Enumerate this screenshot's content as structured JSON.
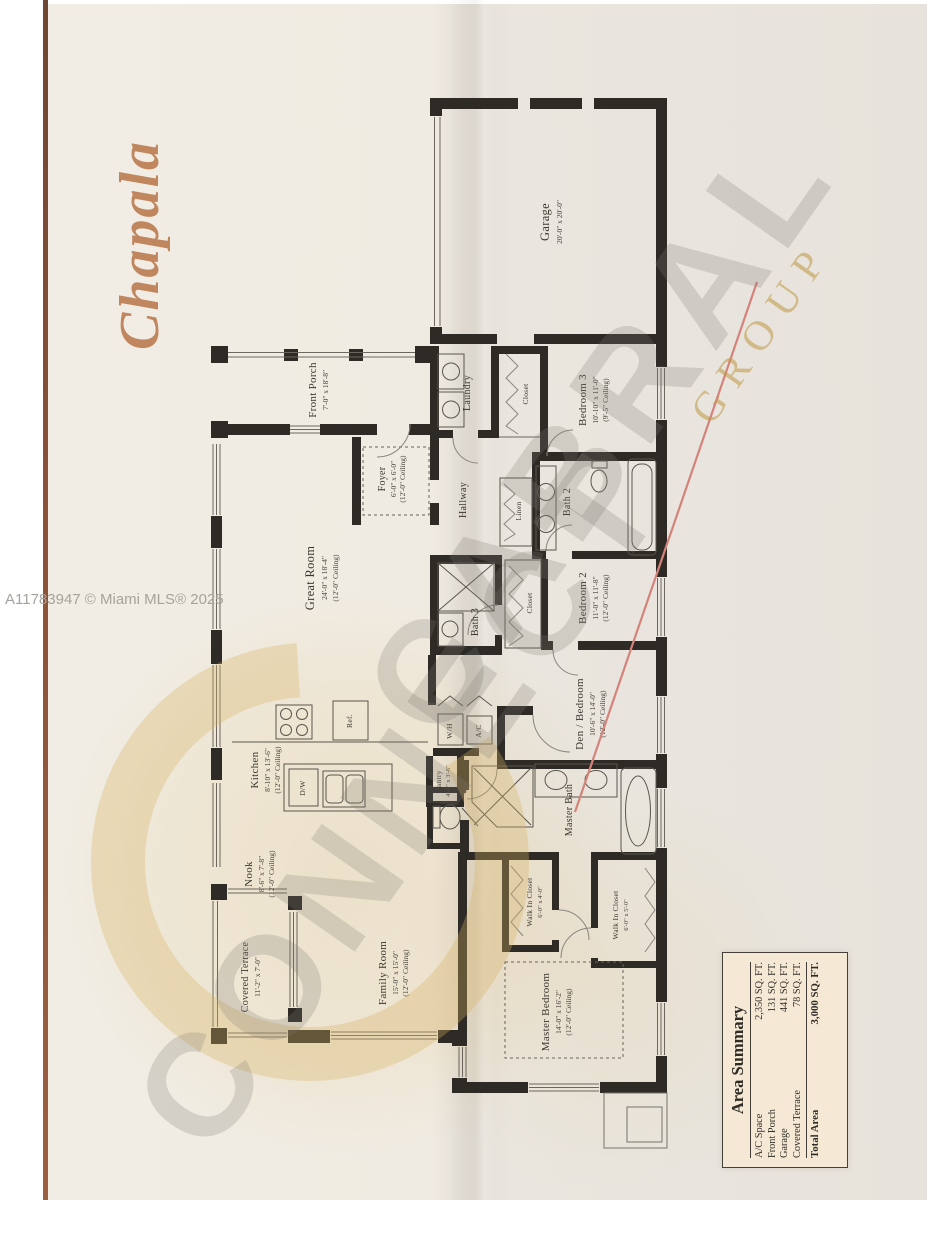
{
  "plan": {
    "model_name": "Chapala"
  },
  "credit": {
    "text": "A11783947 © Miami MLS® 2025"
  },
  "watermark": {
    "word1": "CONNECT",
    "word2": "CABRAL",
    "word3": "GROUP",
    "logo_letter": "C"
  },
  "colors": {
    "accent_copper": "#c0875f",
    "wall": "#2e2b27",
    "watermark_gold": "#d8b260",
    "watermark_gray": "#7d7972",
    "red_line": "#d4837b",
    "summary_bg": "#f5e9d5"
  },
  "rooms": [
    {
      "name": "Garage",
      "dims": "20'-0\" x 20'-0\"",
      "ceiling": ""
    },
    {
      "name": "Front Porch",
      "dims": "7'-0\" x 18'-8\"",
      "ceiling": ""
    },
    {
      "name": "Laundry",
      "dims": "",
      "ceiling": ""
    },
    {
      "name": "Closet",
      "dims": "",
      "ceiling": ""
    },
    {
      "name": "Bedroom 3",
      "dims": "10'-10\" x 11'-0\"",
      "ceiling": "(9'-5\" Ceiling)"
    },
    {
      "name": "Foyer",
      "dims": "6'-0\" x 6'-0\"",
      "ceiling": "(12'-0\" Ceiling)"
    },
    {
      "name": "Hallway",
      "dims": "",
      "ceiling": ""
    },
    {
      "name": "Linen",
      "dims": "",
      "ceiling": ""
    },
    {
      "name": "Bath 2",
      "dims": "",
      "ceiling": ""
    },
    {
      "name": "Great Room",
      "dims": "24'-0\" x 18'-4\"",
      "ceiling": "(12'-0\" Ceiling)"
    },
    {
      "name": "Bath 3",
      "dims": "",
      "ceiling": ""
    },
    {
      "name": "Closet",
      "dims": "",
      "ceiling": ""
    },
    {
      "name": "Bedroom 2",
      "dims": "11'-0\" x 11'-8\"",
      "ceiling": "(12'-0\" Ceiling)"
    },
    {
      "name": "Den / Bedroom",
      "dims": "10'-6\" x 14'-0\"",
      "ceiling": "(12'-0\" Ceiling)"
    },
    {
      "name": "Kitchen",
      "dims": "8'-10\" x 13'-6\"",
      "ceiling": "(12'-0\" Ceiling)"
    },
    {
      "name": "Pantry",
      "dims": "4'-0\" x 3'-6\"",
      "ceiling": ""
    },
    {
      "name": "Master Bath",
      "dims": "",
      "ceiling": ""
    },
    {
      "name": "Nook",
      "dims": "8'-6\" x 7'-8\"",
      "ceiling": "(12'-0\" Ceiling)"
    },
    {
      "name": "Covered Terrace",
      "dims": "11'-2\" x 7'-0\"",
      "ceiling": ""
    },
    {
      "name": "Family Room",
      "dims": "15'-0\" x 15'-0\"",
      "ceiling": "(12'-0\" Ceiling)"
    },
    {
      "name": "Walk In Closet",
      "dims": "6'-0\" x 4'-0\"",
      "ceiling": ""
    },
    {
      "name": "Walk In Closet",
      "dims": "6'-0\" x 5'-0\"",
      "ceiling": ""
    },
    {
      "name": "Master Bedroom",
      "dims": "14'-0\" x 16'-2\"",
      "ceiling": "(12'-0\" Ceiling)"
    }
  ],
  "fixtures": {
    "ref": "Ref.",
    "dw": "D/W",
    "wh": "W/H",
    "ac": "A/C"
  },
  "summary": {
    "title": "Area Summary",
    "rows": [
      {
        "label": "A/C Space",
        "value": "2,350 SQ. FT."
      },
      {
        "label": "Front Porch",
        "value": "131 SQ. FT."
      },
      {
        "label": "Garage",
        "value": "441 SQ. FT."
      },
      {
        "label": "Covered Terrace",
        "value": "78 SQ. FT."
      }
    ],
    "total": {
      "label": "Total Area",
      "value": "3,000 SQ. FT."
    }
  }
}
